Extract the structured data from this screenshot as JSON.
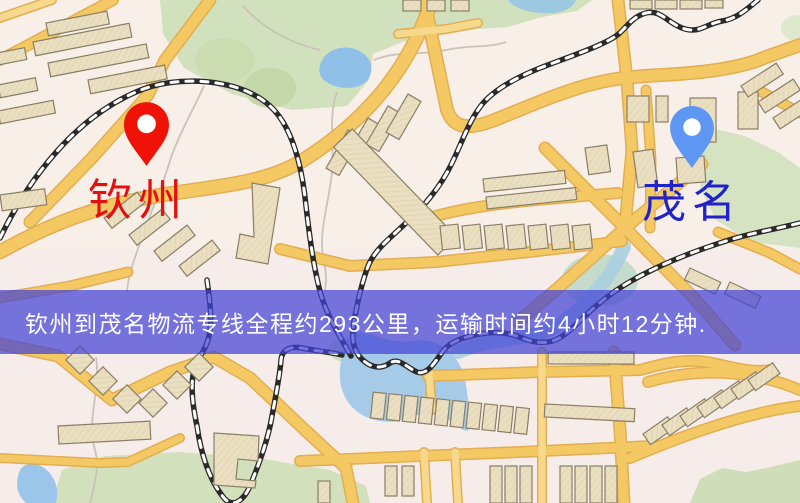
{
  "map": {
    "title": "route-map",
    "markers": [
      {
        "id": "qinzhou",
        "label": "钦州",
        "pin_color": "#ee1306",
        "label_color": "#e31010",
        "icon": "map-pin-red"
      },
      {
        "id": "maoming",
        "label": "茂名",
        "pin_color": "#5d96f3",
        "label_color": "#2023c9",
        "icon": "map-pin-blue"
      }
    ],
    "banner": {
      "text": "钦州到茂名物流专线全程约293公里，运输时间约4小时12分钟.",
      "background": "rgba(66,66,214,0.72)",
      "text_color": "#ffffff"
    },
    "route": {
      "origin": "钦州",
      "destination": "茂名",
      "distance_km": 293,
      "duration": "4小时12分钟"
    },
    "legend_colors": {
      "road": "#f4c964",
      "road_casing": "#e3ad52",
      "building": "#ebdfc2",
      "park": "#d2e1bd",
      "water": "#a5cbe8",
      "railway": "#222222",
      "base": "#f7efe8"
    }
  }
}
